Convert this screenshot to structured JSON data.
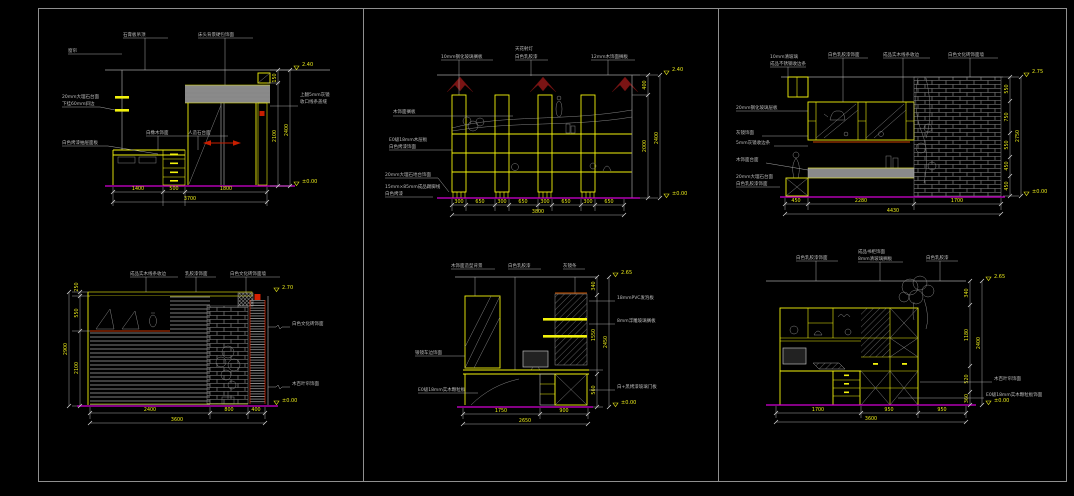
{
  "canvas": {
    "background": "#000000",
    "frame_color": "#8f8f8f"
  },
  "colors": {
    "furniture": "#f2f20c",
    "annotation": "#bdbdbd",
    "hatch": "#9a9a9a",
    "baseline_magenta": "#d400d4",
    "accent_red": "#c81e00",
    "spotlight_red": "#7a1414"
  },
  "p1": {
    "top_labels": [
      "石膏板吊顶",
      "床头背景硬包饰面"
    ],
    "label_curtain": "窗帘",
    "label_counter_1": "20mm大理石台面",
    "label_counter_2": "下挂60mm斜边",
    "label_desk_1": "白橡木饰面",
    "label_desk_2": "人造石台面",
    "label_drawer": "白色烤漆抽屉面板",
    "label_right_1": "上翻5mm灰镜",
    "label_right_2": "收口线条盖缝",
    "dims_bottom": [
      "1400",
      "500",
      "1800"
    ],
    "dim_total": "3700",
    "dims_right": [
      "150",
      "2100"
    ],
    "dim_right_total": "2400",
    "level_top": "2.40",
    "level_bottom": "±0.00"
  },
  "p2": {
    "top_labels": [
      "10mm钢化玻璃搁板",
      "天花射灯",
      "白色乳胶漆",
      "12mm木饰面搁板"
    ],
    "left_labels": [
      "木饰面搁板",
      "E0级18mm木层板",
      "白色烤漆饰面",
      "20mm大理石地台饰面",
      "15mm×85mm成品踢脚线",
      "白色烤漆"
    ],
    "dims_bottom": [
      "300",
      "650",
      "300",
      "650",
      "300",
      "650",
      "300",
      "650"
    ],
    "dim_total": "3800",
    "dims_right": [
      "400",
      "2000"
    ],
    "dim_right_total": "2400",
    "level_top": "2.40",
    "level_bottom": "±0.00"
  },
  "p3": {
    "corner_labels": [
      "10mm清玻璃",
      "成品不锈钢收边条"
    ],
    "top_labels": [
      "白色乳胶漆饰面",
      "成品实木线条收边",
      "白色文化砖饰面墙"
    ],
    "left_labels": [
      "20mm钢化玻璃层板",
      "灰镜饰面",
      "5mm灰镜收边条",
      "木饰面台面",
      "20mm大理石台面",
      "白色乳胶漆饰面"
    ],
    "dims_bottom": [
      "450",
      "2280",
      "1700"
    ],
    "dim_total": "4430",
    "dims_right": [
      "550",
      "750",
      "550",
      "450",
      "450"
    ],
    "dim_right_total": "2750",
    "level_top": "2.75",
    "level_bottom": "±0.00"
  },
  "p4": {
    "top_labels": [
      "成品实木线条收边",
      "乳胶漆饰面",
      "白色文化砖饰面墙"
    ],
    "right_labels": [
      "白色文化砖饰面",
      "木百叶帘饰面"
    ],
    "dims_bottom": [
      "2400",
      "800",
      "400"
    ],
    "dim_total": "3600",
    "dims_left": [
      "250",
      "550",
      "2100"
    ],
    "dim_left_total": "2900",
    "level_top": "2.70",
    "level_bottom": "±0.00"
  },
  "p5": {
    "top_labels": [
      "木饰面造型背景",
      "白色乳胶漆",
      "灰镜条"
    ],
    "right_labels": [
      "18mmPVC发泡板",
      "8mm浮雕玻璃搁板",
      "白+黑烤漆玻璃门板"
    ],
    "left_labels": [
      "银镜车边饰面",
      "E0级18mm实木颗粒板"
    ],
    "dims_bottom": [
      "1750",
      "900"
    ],
    "dim_total": "2650",
    "dims_right": [
      "340",
      "1550",
      "560"
    ],
    "dim_right_total": "2450",
    "level_top": "2.65",
    "level_bottom": "±0.00"
  },
  "p6": {
    "top_labels": [
      "白色乳胶漆饰面",
      "成品书柜饰面",
      "8mm清玻璃搁板",
      "白色乳胶漆"
    ],
    "right_labels": [
      "木百叶帘饰面",
      "E0级18mm实木颗粒板饰面"
    ],
    "dims_bottom": [
      "1700",
      "950",
      "950"
    ],
    "dim_total": "3600",
    "dims_right": [
      "340",
      "1180",
      "520",
      "360"
    ],
    "dim_right_total": "2400",
    "level_top": "2.65",
    "level_bottom": "±0.00"
  }
}
